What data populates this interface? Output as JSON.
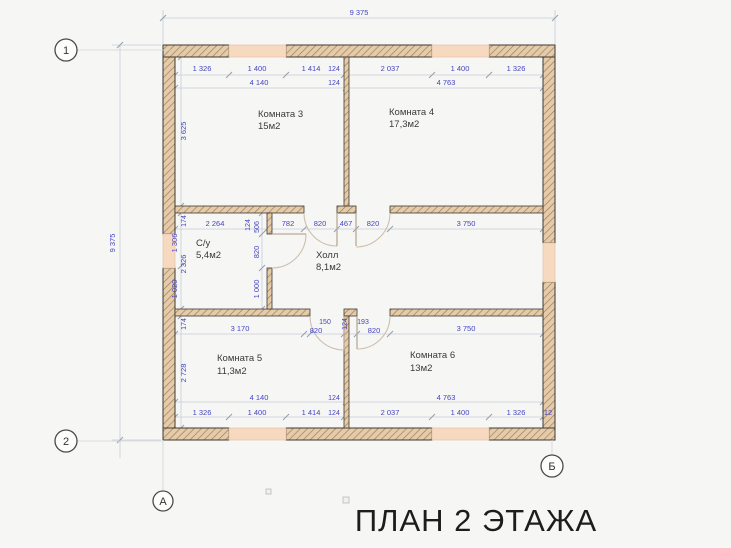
{
  "title": "ПЛАН 2 ЭТАЖА",
  "axes": {
    "r1": "1",
    "r2": "2",
    "cA": "А",
    "cB": "Б"
  },
  "overall": {
    "top": "9 375",
    "left": "9 375"
  },
  "rooms": {
    "room3": {
      "name": "Комната 3",
      "area": "15м2"
    },
    "room4": {
      "name": "Комната 4",
      "area": "17,3м2"
    },
    "wc": {
      "name": "С/у",
      "area": "5,4м2"
    },
    "hall": {
      "name": "Холл",
      "area": "8,1м2"
    },
    "room5": {
      "name": "Комната 5",
      "area": "11,3м2"
    },
    "room6": {
      "name": "Комната 6",
      "area": "13м2"
    }
  },
  "dims": {
    "top_row1": [
      "1 326",
      "1 400",
      "1 414",
      "124",
      "2 037",
      "1 400",
      "1 326"
    ],
    "top_row2": [
      "4 140",
      "124",
      "4 763"
    ],
    "mid_top": [
      "2 264",
      "124",
      "782",
      "820",
      "467",
      "820",
      "3 750"
    ],
    "mid_bottom": [
      "3 170",
      "150",
      "820",
      "124",
      "193",
      "820",
      "3 750"
    ],
    "left_col": [
      "3 625",
      "174",
      "1 306",
      "2 326",
      "1 020",
      "174",
      "2 728"
    ],
    "wc_wall": [
      "506",
      "820",
      "1 000"
    ],
    "bottom_row1": [
      "4 140",
      "124",
      "4 763"
    ],
    "bottom_row2": [
      "1 326",
      "1 400",
      "1 414",
      "124",
      "2 037",
      "1 400",
      "1 326",
      "12"
    ]
  },
  "colors": {
    "wall_fill": "#e6cba9",
    "wall_hatch": "#9a8063",
    "wall_outline": "#3e3a34",
    "window_fill": "#f7d9c0",
    "dim_text": "#4444c4",
    "room_text": "#3a3a3a",
    "dim_line": "#c6cdd8"
  }
}
